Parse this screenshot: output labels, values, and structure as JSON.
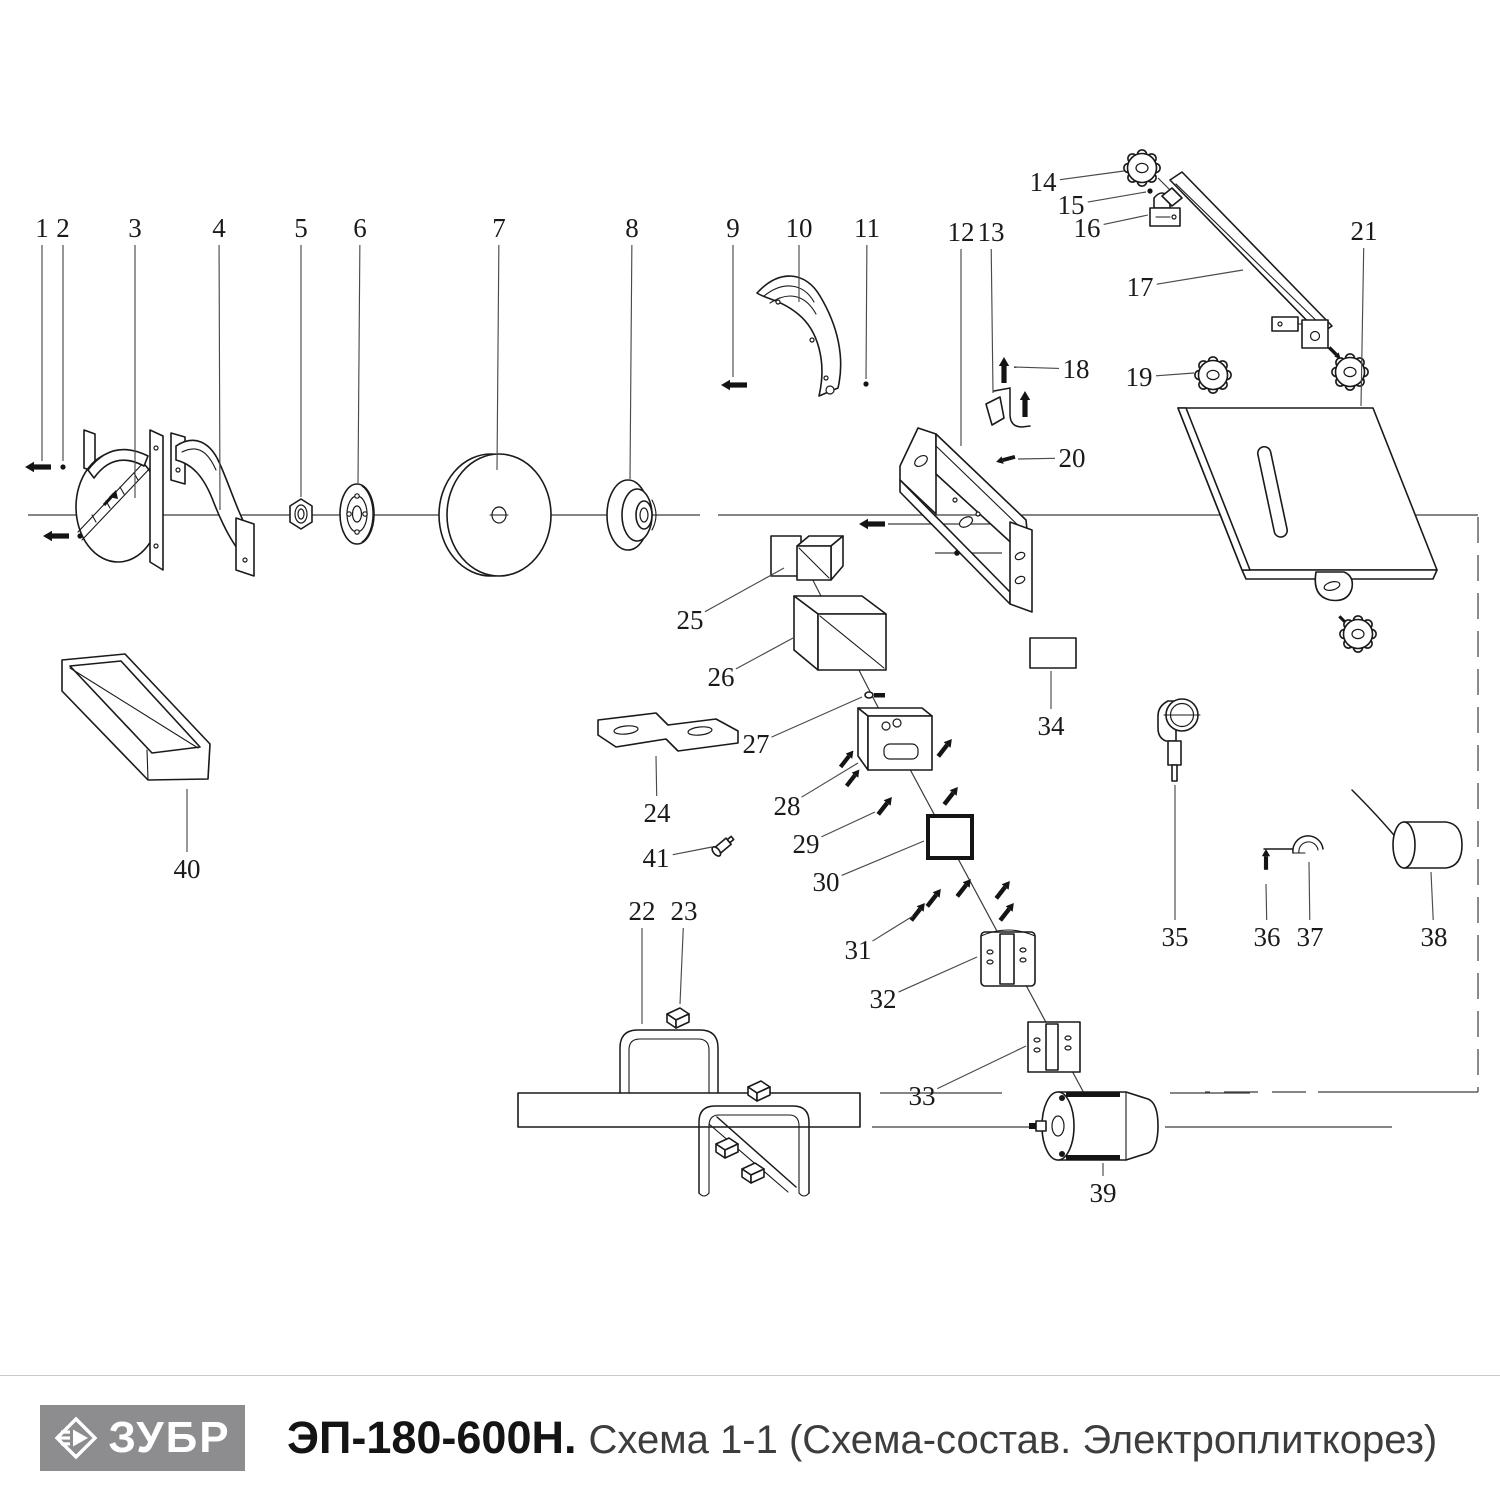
{
  "footer": {
    "brand": "ЗУБР",
    "model": "ЭП-180-600Н.",
    "subtitle": "Схема 1-1 (Схема-состав. Электроплиткорез)",
    "logo_bg": "#8d8d8f",
    "logo_text_color": "#ffffff",
    "separator_color": "#c9c9c9"
  },
  "diagram": {
    "line_color": "#1a1a1a",
    "callouts": [
      {
        "label": "1",
        "lx": 42,
        "ly": 228,
        "tx": 42,
        "ty": 461
      },
      {
        "label": "2",
        "lx": 63,
        "ly": 228,
        "tx": 63,
        "ty": 461
      },
      {
        "label": "3",
        "lx": 135,
        "ly": 228,
        "tx": 135,
        "ty": 498
      },
      {
        "label": "4",
        "lx": 219,
        "ly": 228,
        "tx": 220,
        "ty": 510
      },
      {
        "label": "5",
        "lx": 301,
        "ly": 228,
        "tx": 301,
        "ty": 497
      },
      {
        "label": "6",
        "lx": 360,
        "ly": 228,
        "tx": 358,
        "ty": 483
      },
      {
        "label": "7",
        "lx": 499,
        "ly": 228,
        "tx": 497,
        "ty": 470
      },
      {
        "label": "8",
        "lx": 632,
        "ly": 228,
        "tx": 630,
        "ty": 479
      },
      {
        "label": "9",
        "lx": 733,
        "ly": 228,
        "tx": 733,
        "ty": 377
      },
      {
        "label": "10",
        "lx": 799,
        "ly": 228,
        "tx": 799,
        "ty": 302
      },
      {
        "label": "11",
        "lx": 867,
        "ly": 228,
        "tx": 866,
        "ty": 379
      },
      {
        "label": "12",
        "lx": 961,
        "ly": 232,
        "tx": 961,
        "ty": 446
      },
      {
        "label": "13",
        "lx": 991,
        "ly": 232,
        "tx": 993,
        "ty": 393
      },
      {
        "label": "14",
        "lx": 1043,
        "ly": 182,
        "tx": 1124,
        "ty": 171
      },
      {
        "label": "15",
        "lx": 1071,
        "ly": 205,
        "tx": 1146,
        "ty": 192
      },
      {
        "label": "16",
        "lx": 1087,
        "ly": 228,
        "tx": 1148,
        "ty": 215
      },
      {
        "label": "17",
        "lx": 1140,
        "ly": 287,
        "tx": 1243,
        "ty": 270
      },
      {
        "label": "18",
        "lx": 1076,
        "ly": 369,
        "tx": 1014,
        "ty": 367
      },
      {
        "label": "19",
        "lx": 1139,
        "ly": 377,
        "tx": 1194,
        "ty": 373
      },
      {
        "label": "20",
        "lx": 1072,
        "ly": 458,
        "tx": 1018,
        "ty": 459
      },
      {
        "label": "21",
        "lx": 1364,
        "ly": 231,
        "tx": 1361,
        "ty": 406
      },
      {
        "label": "22",
        "lx": 642,
        "ly": 911,
        "tx": 642,
        "ty": 1024
      },
      {
        "label": "23",
        "lx": 684,
        "ly": 911,
        "tx": 680,
        "ty": 1004
      },
      {
        "label": "24",
        "lx": 657,
        "ly": 813,
        "tx": 656,
        "ty": 756
      },
      {
        "label": "25",
        "lx": 690,
        "ly": 620,
        "tx": 784,
        "ty": 568
      },
      {
        "label": "26",
        "lx": 721,
        "ly": 677,
        "tx": 793,
        "ty": 638
      },
      {
        "label": "27",
        "lx": 756,
        "ly": 744,
        "tx": 862,
        "ty": 697
      },
      {
        "label": "28",
        "lx": 787,
        "ly": 806,
        "tx": 858,
        "ty": 763
      },
      {
        "label": "29",
        "lx": 806,
        "ly": 844,
        "tx": 875,
        "ty": 812
      },
      {
        "label": "30",
        "lx": 826,
        "ly": 882,
        "tx": 924,
        "ty": 841
      },
      {
        "label": "31",
        "lx": 858,
        "ly": 950,
        "tx": 913,
        "ty": 916
      },
      {
        "label": "32",
        "lx": 883,
        "ly": 999,
        "tx": 977,
        "ty": 957
      },
      {
        "label": "33",
        "lx": 922,
        "ly": 1096,
        "tx": 1026,
        "ty": 1046
      },
      {
        "label": "34",
        "lx": 1051,
        "ly": 726,
        "tx": 1051,
        "ty": 671
      },
      {
        "label": "35",
        "lx": 1175,
        "ly": 937,
        "tx": 1175,
        "ty": 785
      },
      {
        "label": "36",
        "lx": 1267,
        "ly": 937,
        "tx": 1266,
        "ty": 884
      },
      {
        "label": "37",
        "lx": 1310,
        "ly": 937,
        "tx": 1309,
        "ty": 862
      },
      {
        "label": "38",
        "lx": 1434,
        "ly": 937,
        "tx": 1431,
        "ty": 872
      },
      {
        "label": "39",
        "lx": 1103,
        "ly": 1193,
        "tx": 1103,
        "ty": 1163
      },
      {
        "label": "40",
        "lx": 187,
        "ly": 869,
        "tx": 187,
        "ty": 789
      },
      {
        "label": "41",
        "lx": 656,
        "ly": 858,
        "tx": 712,
        "ty": 847
      }
    ]
  }
}
